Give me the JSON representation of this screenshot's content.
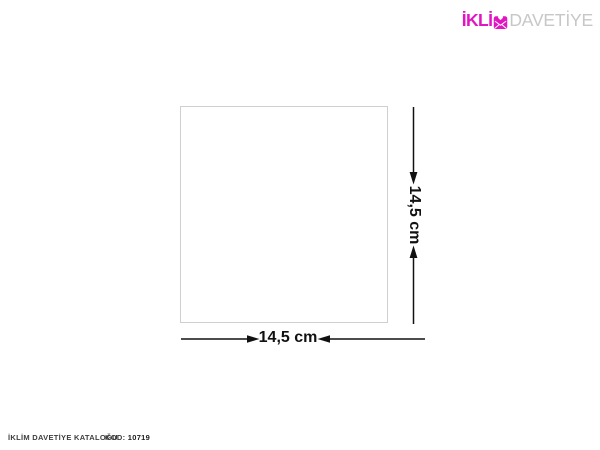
{
  "brand": {
    "name_prefix": "İKLİ",
    "m_icon": "envelope-heart-icon",
    "name_suffix": "DAVETİYE",
    "primary_color": "#e116c2",
    "suffix_color": "#c7c7c7"
  },
  "diagram": {
    "shape": "square",
    "width_label": "14,5 cm",
    "height_label": "14,5 cm",
    "outline_color": "#cfcfcf",
    "line_color": "#111111"
  },
  "footer": {
    "catalog_label": "İKLİM DAVETİYE KATALOĞU",
    "code_label": "KOD:",
    "code_value": "10719"
  }
}
